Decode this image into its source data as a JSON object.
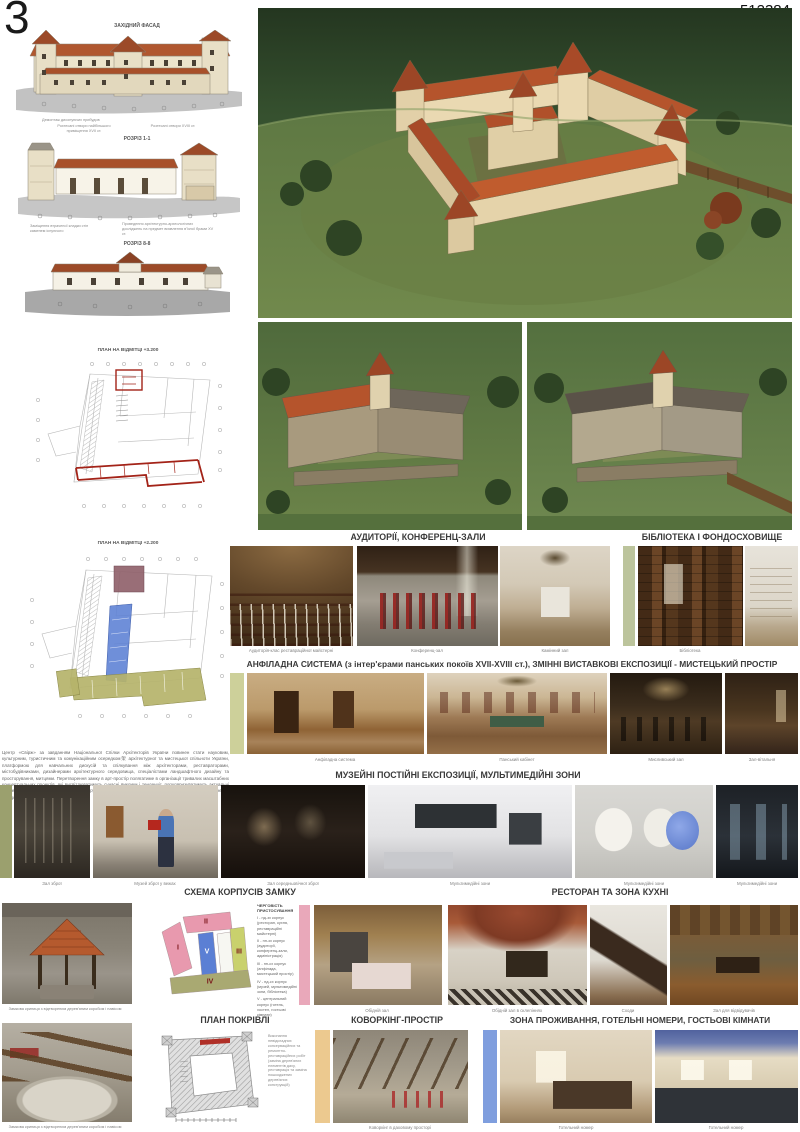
{
  "page": {
    "sheet_number": "3",
    "entry_code": "512384"
  },
  "left_panel": {
    "facade": {
      "title": "ЗАХІДНИЙ ФАСАД",
      "note": "Демонтаж дисонуючих прибудов"
    },
    "section_1": {
      "title": "РОЗРІЗ 1-1",
      "note_left": "Розтесані отвори найбільшого приміщення XVII ст.",
      "note_right": "Розтесані отвори XVIII ст.",
      "note_bottom_left": "Заміщення втраченої кладки стін каменем існуючого",
      "note_bottom_right": "Проведення архітектурно-археологічних досліджень на предмет виявлення в'їзної брами XV ст."
    },
    "section_8": {
      "title": "РОЗРІЗ 8-8"
    },
    "plan_upper": {
      "title": "ПЛАН НА ВІДМІТЦІ +3.200"
    },
    "plan_lower": {
      "title": "ПЛАН НА ВІДМІТЦІ +2.200"
    },
    "description": "Центр «Свірж» за завданням Національної Спілки Архітекторів України повинен стати науковим, культурним, туристичним та комунікаційним осередком架 архітектурної та мистецької спільноти України, платформою для навчальних дискусій та спілкування між архітекторами, реставраторами, містобудівниками, дизайнерами архітектурного середовища, спеціалістами ландшафтного дизайну та просторування, митцями. Перетворення замку в арт-простір полягатиме в організації тривалих масштабних концептуальних проектів, які висвітлюватимуть сучасні виклики і тенденції, популяризуватимуть актуальні мистецтва. Просвітницька діяльність центру позитивно вплине на соціальну активність молоді, її долучення до здобутків історії, культури і мистецтва."
  },
  "sections": {
    "auditoriums": {
      "title": "АУДИТОРІЇ, КОНФЕРЕНЦ-ЗАЛИ",
      "captions": [
        "Аудиторія-клас реставраційної майстерні",
        "Конференц-зал",
        "Камінний зал"
      ]
    },
    "library": {
      "title": "БІБЛІОТЕКА І ФОНДОСХОВИЩЕ",
      "caption": "Бібліотека"
    },
    "enfilade": {
      "title": "АНФІЛАДНА СИСТЕМА (з інтер'єрами панських покоїв XVII-XVIII ст.), ЗМІННІ ВИСТАВКОВІ ЕКСПОЗИЦІЇ - МИСТЕЦЬКИЙ ПРОСТІР",
      "captions": [
        "Анфіладна система",
        "Панський кабінет",
        "Мисливський зал",
        "Зал-вітальня"
      ]
    },
    "museum": {
      "title": "МУЗЕЙНІ ПОСТІЙНІ ЕКСПОЗИЦІЇ, МУЛЬТИМЕДІЙНІ ЗОНИ",
      "captions": [
        "Зал зброї",
        "Музей зброї у вежах",
        "Зал середньовічної зброї",
        "Мультимедійні зони",
        "Мультимедійні зони",
        "Мультимедійні зони"
      ]
    },
    "schema": {
      "title": "СХЕМА КОРПУСІВ ЗАМКУ",
      "legend_title": "ЧЕРГОВІСТЬ ПРИСТОСУВАННЯ",
      "legend": [
        "І - пд-зх корпус (ресторан, кухня, реставраційні майстерні)",
        "ІІ - пн-зх корпус (аудиторії, конференц-зали, адміністрація)",
        "ІІІ - пн-сх корпус (анфілада, мистецький простір)",
        "IV - пд-сх корпус (музей, мультимедійні зони, бібліотека)",
        "V - центральний корпус (готель, хостел, гостьові кімнати)"
      ],
      "block_labels": [
        "І",
        "ІІ",
        "ІІІ",
        "IV",
        "V"
      ]
    },
    "restaurant": {
      "title": "РЕСТОРАН ТА ЗОНА КУХНІ",
      "captions": [
        "Обідній зал",
        "Обідній зал в склепіннях",
        "Сходи",
        "Зал для відвідувачів"
      ]
    },
    "roof_plan": {
      "title": "ПЛАН ПОКРІВЛІ",
      "note": "Виконання невідкладних консерваційних та ремонтно-реставраційних робіт (заміна дерев'яних елементів даху, реставрація та заміна пошкоджених дерев'яних конструкцій)"
    },
    "coworking": {
      "title": "КОВОРКІНГ-ПРОСТІР",
      "caption": "Коворкінг в даховому просторі"
    },
    "hotel": {
      "title": "ЗОНА ПРОЖИВАННЯ, ГОТЕЛЬНІ НОМЕРИ, ГОСТЬОВІ КІМНАТИ",
      "captions": [
        "Готельний номер",
        "Готельний номер"
      ]
    },
    "well": {
      "caption_top": "Замкова криниця з відтвореним дерев'яним коробом і навісом",
      "caption_bottom": "Замкова криниця з відтвореним дерев'яним коробом і навісом"
    }
  },
  "colors": {
    "roof_orange": "#b9572e",
    "wall_cream": "#efe6cf",
    "water_green": "#36512f",
    "grass_green": "#71894c",
    "accent_pink": "#e9a8ba",
    "accent_blue": "#7f9ede",
    "accent_tan": "#ecc98f",
    "accent_sage": "#bcc49c",
    "accent_olive": "#9ba06e",
    "plan_red": "#a32318",
    "plan_blue": "#5b7fd4",
    "plan_olive": "#b5b36a",
    "plan_maroon": "#8e5e68"
  }
}
